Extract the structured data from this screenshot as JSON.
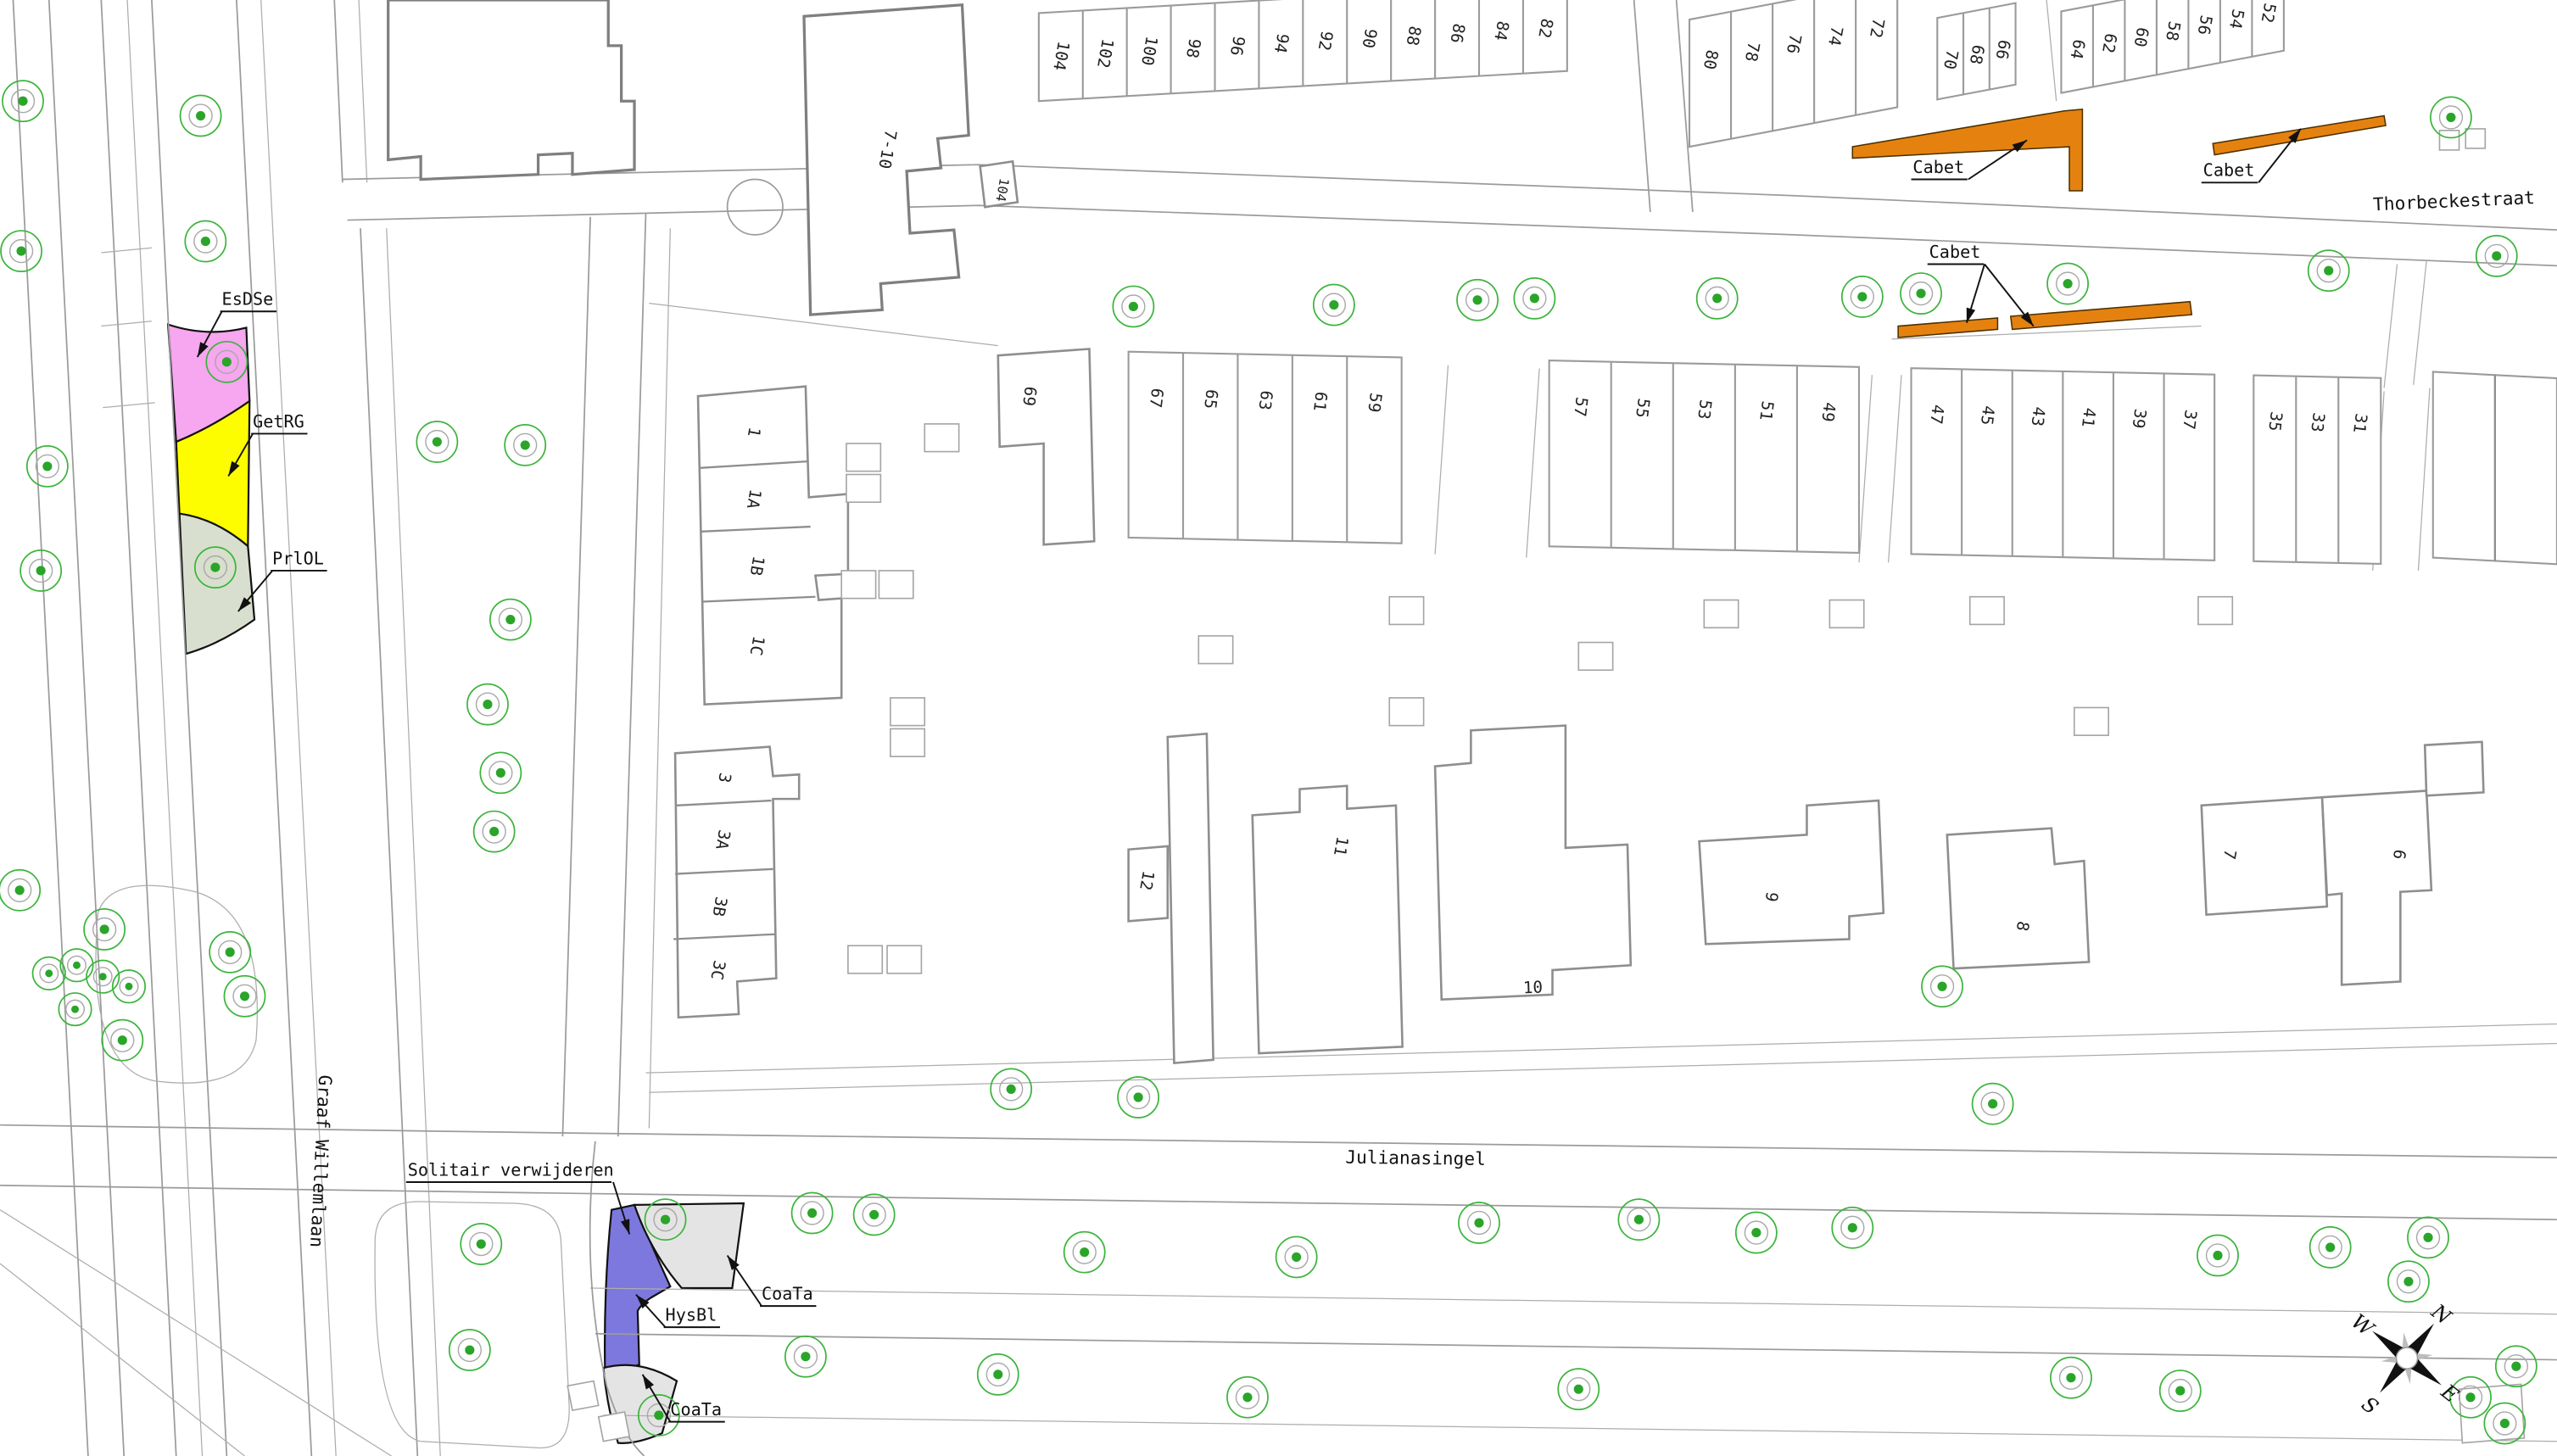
{
  "map": {
    "streets": {
      "thorbeckestraat": "Thorbeckestraat",
      "julianasingel": "Julianasingel",
      "graaf_willemlaan": "Graaf Willemlaan",
      "boxed_number": "104"
    },
    "areas": {
      "esdse": {
        "label": "EsDSe",
        "color": "#f7a6f0"
      },
      "getrg": {
        "label": "GetRG",
        "color": "#fdfd00"
      },
      "prlol": {
        "label": "PrlOL",
        "color": "#d9dfce"
      },
      "cabet": {
        "label": "Cabet",
        "color": "#e5820f"
      },
      "coata": {
        "label": "CoaTa",
        "color": "#e4e4e4"
      },
      "hysbl": {
        "label": "HysBl",
        "color": "#7d78de"
      }
    },
    "notes": {
      "solitair_verwijderen": "Solitair verwijderen"
    },
    "house_numbers": {
      "north_a": [
        "104",
        "102",
        "100",
        "98",
        "96",
        "94",
        "92",
        "90",
        "88",
        "86",
        "84",
        "82"
      ],
      "north_b": [
        "80",
        "78",
        "76",
        "74",
        "72"
      ],
      "north_c": [
        "70",
        "68",
        "66"
      ],
      "north_d": [
        "64",
        "62",
        "60",
        "58",
        "56",
        "54",
        "52"
      ],
      "south_a": [
        "69",
        "67",
        "65",
        "63",
        "61",
        "59"
      ],
      "south_b": [
        "57",
        "55",
        "53",
        "51",
        "49"
      ],
      "south_c": [
        "47",
        "45",
        "43",
        "41",
        "39",
        "37"
      ],
      "south_d": [
        "35",
        "33",
        "31"
      ]
    },
    "building_labels": {
      "b710": "7-10",
      "b1": [
        "1",
        "1A",
        "1B",
        "1C"
      ],
      "b3": [
        "3",
        "3A",
        "3B",
        "3C"
      ],
      "b12": "12",
      "b11": "11",
      "b10": "10",
      "b9": "9",
      "b8": "8",
      "b7": "7",
      "b6": "6"
    },
    "compass": {
      "n": "N",
      "e": "E",
      "s": "S",
      "w": "W"
    },
    "tree_symbol_color": "#2aa52a",
    "trees": [
      [
        14,
        62
      ],
      [
        13,
        154
      ],
      [
        123,
        71
      ],
      [
        126,
        148
      ],
      [
        29,
        286
      ],
      [
        25,
        350
      ],
      [
        139,
        222
      ],
      [
        132,
        348
      ],
      [
        268,
        271
      ],
      [
        322,
        273
      ],
      [
        313,
        380
      ],
      [
        299,
        432
      ],
      [
        307,
        474
      ],
      [
        303,
        510
      ],
      [
        12,
        546
      ],
      [
        64,
        570
      ],
      [
        47,
        592,
        0.8
      ],
      [
        30,
        597,
        0.8
      ],
      [
        63,
        599,
        0.8
      ],
      [
        79,
        605,
        0.8
      ],
      [
        141,
        584
      ],
      [
        150,
        611
      ],
      [
        46,
        619,
        0.8
      ],
      [
        75,
        638
      ],
      [
        295,
        763
      ],
      [
        288,
        828
      ],
      [
        695,
        188
      ],
      [
        818,
        187
      ],
      [
        906,
        184
      ],
      [
        941,
        183
      ],
      [
        1053,
        183
      ],
      [
        1142,
        182
      ],
      [
        1178,
        180
      ],
      [
        1268,
        174
      ],
      [
        1428,
        166
      ],
      [
        1531,
        157
      ],
      [
        1503,
        72
      ],
      [
        620,
        668
      ],
      [
        698,
        673
      ],
      [
        1191,
        605
      ],
      [
        1222,
        677
      ],
      [
        408,
        748
      ],
      [
        498,
        744
      ],
      [
        536,
        745
      ],
      [
        665,
        768
      ],
      [
        795,
        771
      ],
      [
        907,
        750
      ],
      [
        1005,
        748
      ],
      [
        1077,
        756
      ],
      [
        1136,
        753
      ],
      [
        1360,
        770
      ],
      [
        1429,
        765
      ],
      [
        1489,
        759
      ],
      [
        404,
        868
      ],
      [
        494,
        832
      ],
      [
        612,
        843
      ],
      [
        765,
        857
      ],
      [
        968,
        852
      ],
      [
        1270,
        845
      ],
      [
        1337,
        853
      ],
      [
        1543,
        838
      ],
      [
        1477,
        786
      ],
      [
        1515,
        857
      ],
      [
        1536,
        873
      ]
    ]
  }
}
